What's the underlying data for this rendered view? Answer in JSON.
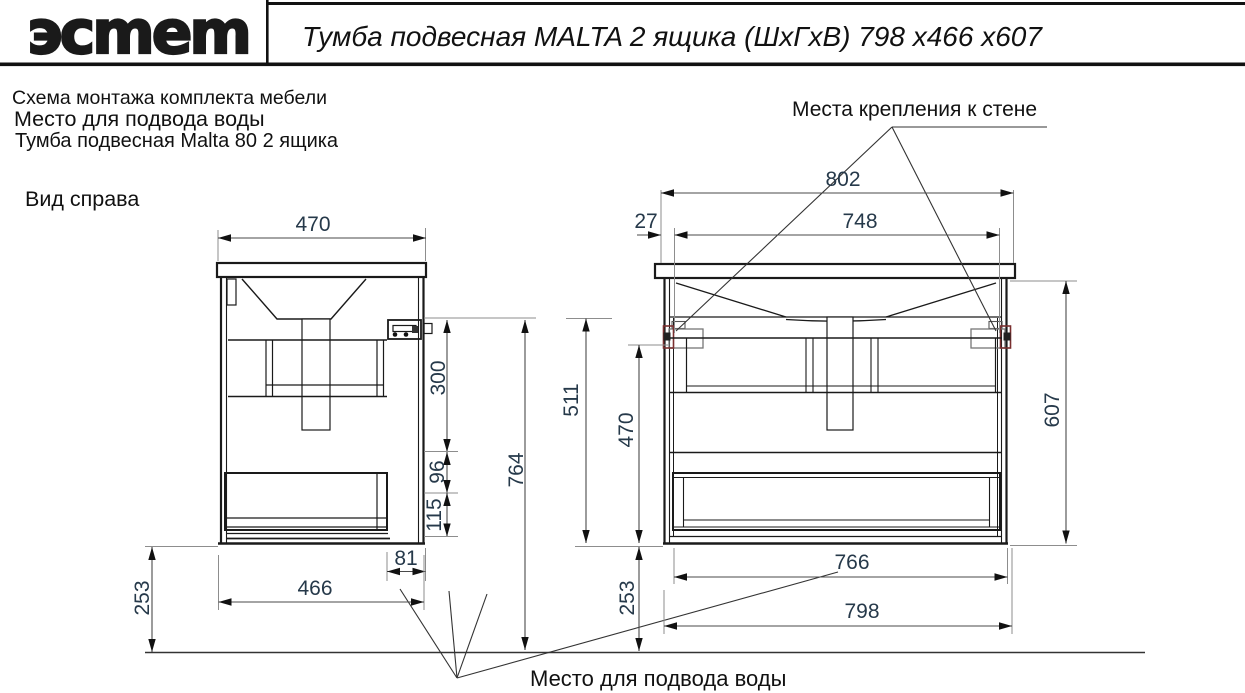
{
  "header": {
    "logo_text": "эсmеm",
    "title": "Тумба подвесная  MALTA 2 ящика  (ШхГхВ) 798 х466 х607"
  },
  "notes": {
    "line1": "Схема монтажа комплекта мебели",
    "line2": "Место для подвода воды",
    "line3": "Тумба подвесная Malta 80   2 ящика"
  },
  "labels": {
    "side_view": "Вид справа",
    "wall_mount": "Места крепления к стене",
    "water_supply": "Место для подвода воды"
  },
  "dims": {
    "side": {
      "width_top": "470",
      "height_upper": "300",
      "height_mid": "96",
      "height_lower": "115",
      "height_total": "764",
      "inset": "81",
      "depth": "466",
      "floor_gap": "253"
    },
    "front": {
      "width_brackets": "802",
      "bracket_offset": "27",
      "bracket_spacing": "748",
      "height_inner": "511",
      "height_body": "470",
      "height_total": "607",
      "width_back": "766",
      "width_body": "798",
      "floor_gap": "253"
    }
  },
  "colors": {
    "line": "#1a1a1a",
    "dimension_text": "#26394a",
    "bracket_accent": "#7a2f2f"
  }
}
